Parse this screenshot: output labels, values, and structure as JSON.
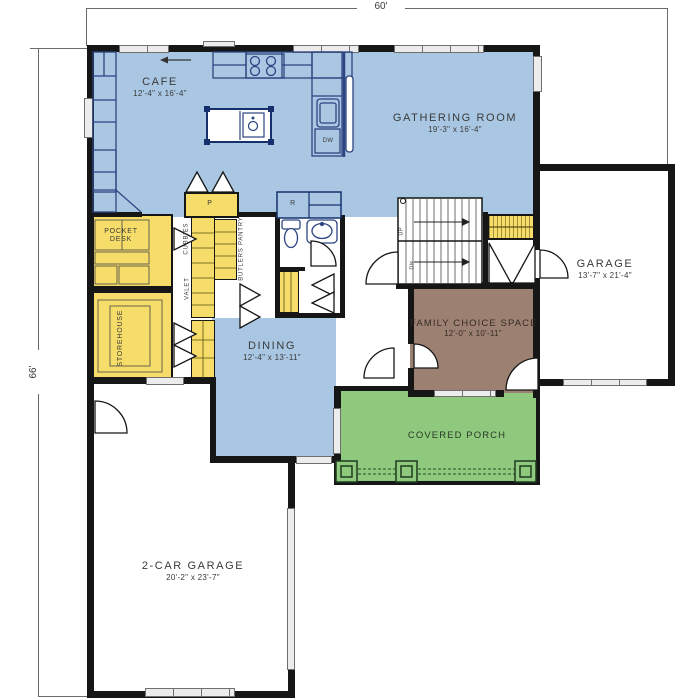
{
  "plan": {
    "overall_dimensions": {
      "width_label": "60'",
      "height_label": "66'"
    },
    "rooms": {
      "cafe": {
        "name": "CAFE",
        "dims": "12'-4\" x 16'-4\""
      },
      "gathering": {
        "name": "GATHERING ROOM",
        "dims": "19'-3\" x 16'-4\""
      },
      "dining": {
        "name": "DINING",
        "dims": "12'-4\" x 13'-11\""
      },
      "family": {
        "name": "FAMILY CHOICE SPACE",
        "dims": "12'-0\" x 10'-11\""
      },
      "garage": {
        "name": "GARAGE",
        "dims": "13'-7\" x 21'-4\""
      },
      "two_car_garage": {
        "name": "2-CAR GARAGE",
        "dims": "20'-2\" x 23'-7\""
      },
      "covered_porch": {
        "name": "COVERED PORCH"
      },
      "pocket_desk": {
        "name_line1": "POCKET",
        "name_line2": "DESK"
      },
      "storehouse": {
        "name": "STOREHOUSE"
      },
      "cubbies": {
        "name": "CUBBIES"
      },
      "valet": {
        "name": "VALET"
      },
      "butlers_pantry": {
        "name": "BUTLERS PANTRY"
      }
    },
    "fixture_labels": {
      "pantry": "P",
      "refrigerator": "R",
      "dishwasher": "DW",
      "stairs_up": "UP",
      "stairs_down": "DN"
    },
    "colors": {
      "living_blue": "#a9c7e3",
      "cabinet_yellow": "#f6dd6a",
      "family_brown": "#9c8172",
      "porch_green": "#8ec97d",
      "wall_black": "#161616",
      "fixture_navy": "#2c4480"
    }
  }
}
